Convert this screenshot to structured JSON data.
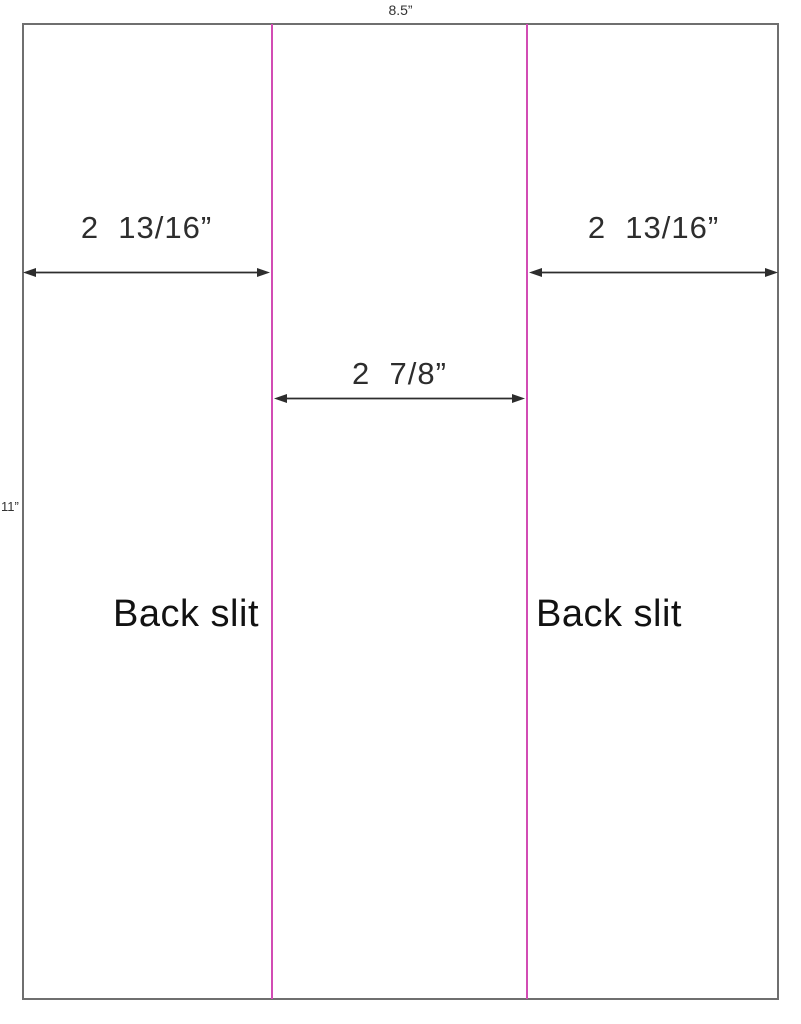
{
  "sheet": {
    "width_label": "8.5”",
    "height_label": "11”"
  },
  "measurements": {
    "left_panel_width": "2  13/16”",
    "center_panel_width": "2  7/8”",
    "right_panel_width": "2  13/16”"
  },
  "slits": {
    "left_label": "Back slit",
    "right_label": "Back slit"
  },
  "colors": {
    "slit_line": "#d24cb4",
    "sheet_border": "#6f6f6f",
    "dimension_ink": "#2d2d2d",
    "slit_label_ink": "#121212"
  }
}
